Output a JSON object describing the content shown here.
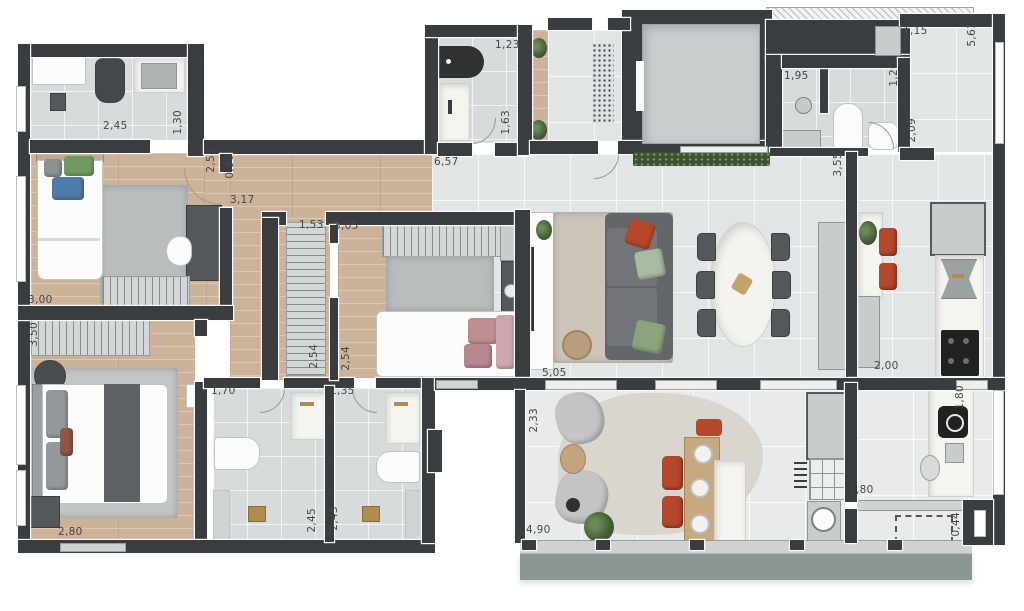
{
  "plan": {
    "title": "apartment-floor-plan",
    "dimension_labels": [
      {
        "text": "2,45",
        "x": 103,
        "y": 120,
        "orientation": "h"
      },
      {
        "text": "1,30",
        "x": 172,
        "y": 110,
        "orientation": "v"
      },
      {
        "text": "1,23",
        "x": 495,
        "y": 39,
        "orientation": "h"
      },
      {
        "text": "1,63",
        "x": 500,
        "y": 110,
        "orientation": "v"
      },
      {
        "text": "6,57",
        "x": 434,
        "y": 156,
        "orientation": "h"
      },
      {
        "text": "1,95",
        "x": 784,
        "y": 70,
        "orientation": "h"
      },
      {
        "text": "1,15",
        "x": 903,
        "y": 25,
        "orientation": "h"
      },
      {
        "text": "5,61",
        "x": 966,
        "y": 22,
        "orientation": "v"
      },
      {
        "text": "1,20",
        "x": 888,
        "y": 62,
        "orientation": "v"
      },
      {
        "text": "2,09",
        "x": 906,
        "y": 118,
        "orientation": "v"
      },
      {
        "text": "3,55",
        "x": 832,
        "y": 152,
        "orientation": "v"
      },
      {
        "text": "2,53",
        "x": 205,
        "y": 148,
        "orientation": "v"
      },
      {
        "text": "0,90",
        "x": 224,
        "y": 154,
        "orientation": "v"
      },
      {
        "text": "3,17",
        "x": 230,
        "y": 194,
        "orientation": "h"
      },
      {
        "text": "1,53",
        "x": 299,
        "y": 219,
        "orientation": "h"
      },
      {
        "text": "3,05",
        "x": 334,
        "y": 220,
        "orientation": "h"
      },
      {
        "text": "3,00",
        "x": 28,
        "y": 294,
        "orientation": "h"
      },
      {
        "text": "3,50",
        "x": 28,
        "y": 322,
        "orientation": "v"
      },
      {
        "text": "2,54",
        "x": 308,
        "y": 344,
        "orientation": "v"
      },
      {
        "text": "2,54",
        "x": 340,
        "y": 346,
        "orientation": "v"
      },
      {
        "text": "5,05",
        "x": 542,
        "y": 367,
        "orientation": "h"
      },
      {
        "text": "2,00",
        "x": 874,
        "y": 360,
        "orientation": "h"
      },
      {
        "text": "1,70",
        "x": 211,
        "y": 385,
        "orientation": "h"
      },
      {
        "text": "1,35",
        "x": 330,
        "y": 385,
        "orientation": "h"
      },
      {
        "text": "2,45",
        "x": 306,
        "y": 508,
        "orientation": "v"
      },
      {
        "text": "2,45",
        "x": 328,
        "y": 506,
        "orientation": "v"
      },
      {
        "text": "2,80",
        "x": 58,
        "y": 526,
        "orientation": "h"
      },
      {
        "text": "2,33",
        "x": 528,
        "y": 408,
        "orientation": "v"
      },
      {
        "text": "4,90",
        "x": 526,
        "y": 524,
        "orientation": "h"
      },
      {
        "text": "1,80",
        "x": 849,
        "y": 484,
        "orientation": "h"
      },
      {
        "text": "1,80",
        "x": 954,
        "y": 385,
        "orientation": "v"
      },
      {
        "text": "0,44",
        "x": 950,
        "y": 512,
        "orientation": "v"
      }
    ],
    "colors": {
      "wall": "#3a3d3f",
      "wood_floor": "#ccb298",
      "tile_floor": "#e2e5e6",
      "bath_tile": "#d7dbdc",
      "balcony_tile": "#e9ebea",
      "ledge": "#8d9792",
      "accent_orange": "#b54a2e",
      "accent_green": "#8aa47e",
      "accent_blue": "#5b83ad",
      "accent_pink": "#c08d94",
      "marble": "#f5f4f1",
      "planter_green": "#3c5232"
    },
    "fixtures": [
      "shower",
      "toilet",
      "washbasin",
      "bathtub-counter",
      "single-bed",
      "double-bed",
      "wardrobe",
      "desk",
      "chair",
      "rug",
      "sofa",
      "tv-console",
      "dining-table",
      "dining-chair",
      "kitchen-island",
      "bar-stool",
      "refrigerator",
      "kitchen-sink",
      "cooktop",
      "elevator",
      "floor-grate",
      "planter",
      "armchair",
      "side-table",
      "floor-lamp",
      "plant",
      "outdoor-table",
      "outdoor-chair",
      "grill-counter",
      "laundry-sink",
      "washing-machine",
      "future-cabinet-outline"
    ]
  }
}
